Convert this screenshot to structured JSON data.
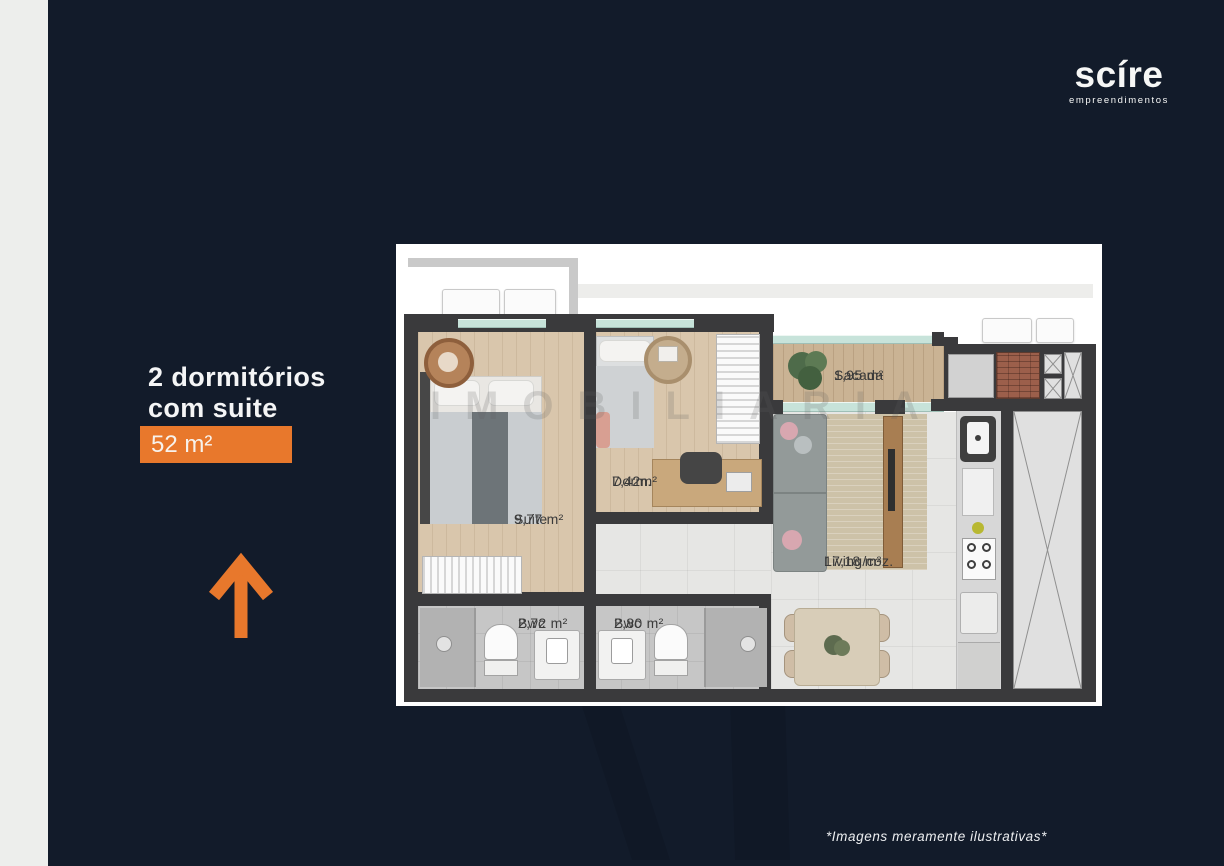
{
  "colors": {
    "navy": "#121b2a",
    "accent": "#e8782c",
    "strip": "#edeeec",
    "wall": "#3a3a3c"
  },
  "logo": {
    "brand": "scíre",
    "tagline": "empreendimentos"
  },
  "headline": {
    "line1": "2 dormitórios",
    "line2": "com suite",
    "badge": "52 m²"
  },
  "plan": {
    "watermark": "IMOBILIARIA",
    "rooms": [
      {
        "key": "suite",
        "label": "Suite",
        "area": "9,77 m²"
      },
      {
        "key": "dorm",
        "label": "Dorm.",
        "area": "7,42m²"
      },
      {
        "key": "bwc1",
        "label": "Bwc",
        "area": "2,72 m²"
      },
      {
        "key": "bwc2",
        "label": "Bwc",
        "area": "2,80 m²"
      },
      {
        "key": "living",
        "label": "Living/coz.",
        "area": "17,18 m²"
      },
      {
        "key": "sacada",
        "label": "Sacada",
        "area": "1,95 m²"
      }
    ]
  },
  "footer": {
    "disclaimer": "*Imagens meramente ilustrativas*"
  }
}
